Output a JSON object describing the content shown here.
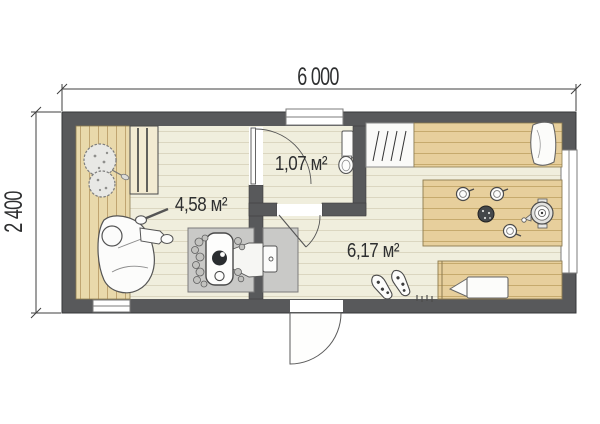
{
  "plan": {
    "dimension_labels": {
      "width": "6 000",
      "height": "2 400"
    },
    "room_area_labels": {
      "sauna": "4,58 м²",
      "washroom": "1,07 м²",
      "lounge": "6,17 м²"
    },
    "colors": {
      "wall": "#58595b",
      "floor": "#f0eedd",
      "platform_wood": "#e9d9ab",
      "furniture_wood": "#e7cf9c",
      "stove_pad": "#c9c9c7",
      "paper": "#ffffff"
    },
    "icons": [
      "plant-icon",
      "tiered-bench",
      "person-with-ladle-figure",
      "sauna-stove",
      "firebox-tunnel",
      "toilet-icon",
      "door-swing",
      "window",
      "coat-hangers-icon",
      "pillow",
      "table-with-tea-set",
      "samovar-icon",
      "cup-icon",
      "plate-icon",
      "slippers-icon",
      "doormat-icon",
      "bench"
    ]
  }
}
